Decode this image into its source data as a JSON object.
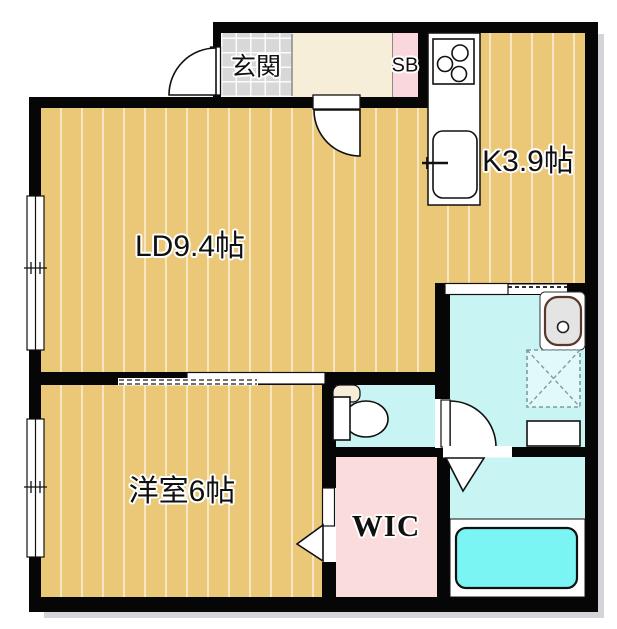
{
  "floorplan": {
    "type": "apartment-floor-plan",
    "rooms": {
      "living_dining": {
        "label": "LD9.4帖"
      },
      "kitchen": {
        "label": "K3.9帖"
      },
      "western_room": {
        "label": "洋室6帖"
      },
      "genkan": {
        "label": "玄関"
      },
      "shoe_box": {
        "label": "SB"
      },
      "walk_in_closet": {
        "label": "WIC"
      },
      "toilet_room": {
        "label": ""
      },
      "washroom": {
        "label": ""
      },
      "bathroom": {
        "label": ""
      }
    },
    "fixtures": [
      "entrance-door",
      "gas-stove",
      "kitchen-counter",
      "kitchen-sink",
      "sliding-door",
      "toilet",
      "washbasin",
      "washing-machine-pan",
      "washroom-counter",
      "bathtub",
      "bath-folding-door",
      "closet-folding-door",
      "window"
    ],
    "colors": {
      "wall": "#060606",
      "wood_floor": "#eac878",
      "entrance_tile": "#d8d8d8",
      "hallway": "#f6eed8",
      "shoe_box_pink": "#f9d7dc",
      "closet_pink": "#fbdcdc",
      "wet_room_cyan": "#c9f4f4",
      "bathtub_cyan": "#7bf4f4"
    }
  }
}
